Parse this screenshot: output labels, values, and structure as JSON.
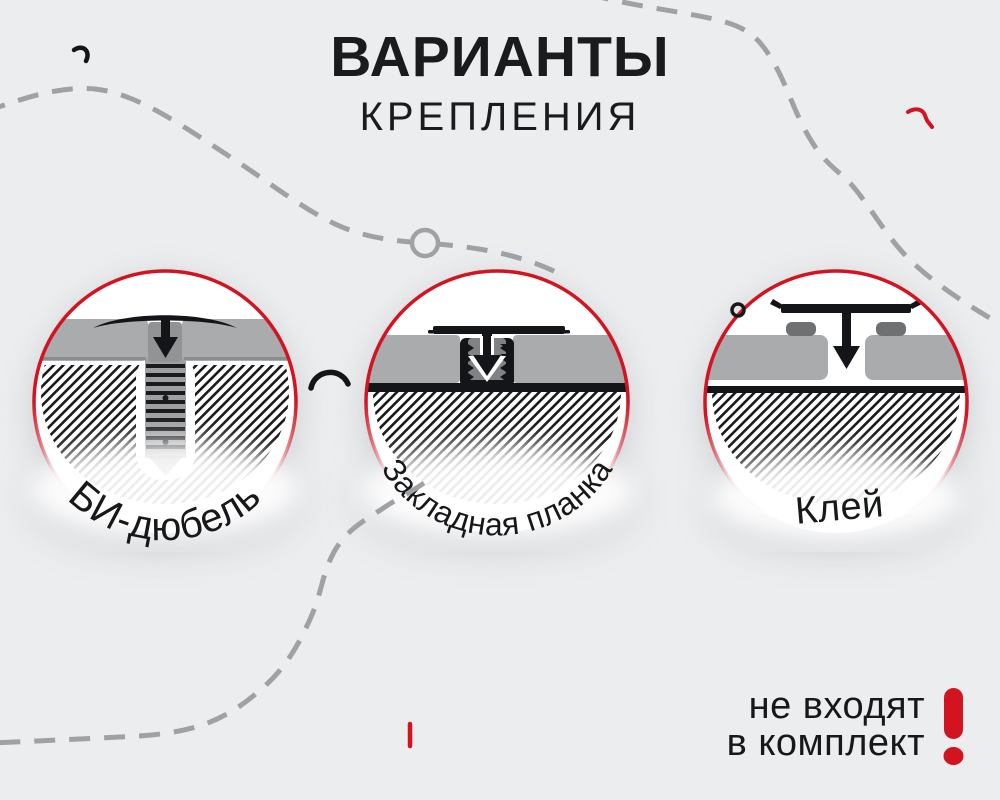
{
  "title": {
    "line1": "ВАРИАНТЫ",
    "line2": "КРЕПЛЕНИЯ"
  },
  "options": [
    {
      "label": "БИ-дюбель"
    },
    {
      "label": "Закладная планка"
    },
    {
      "label": "Клей"
    }
  ],
  "note": {
    "line1": "не входят",
    "line2": "в комплект",
    "mark": "!"
  },
  "colors": {
    "background": "#ECEDEF",
    "red": "#D41320",
    "panel_gray": "#A9ABAD",
    "hatch_ink": "#1A1B1D",
    "dash_gray": "#9FA1A4",
    "ink": "#17181A"
  }
}
